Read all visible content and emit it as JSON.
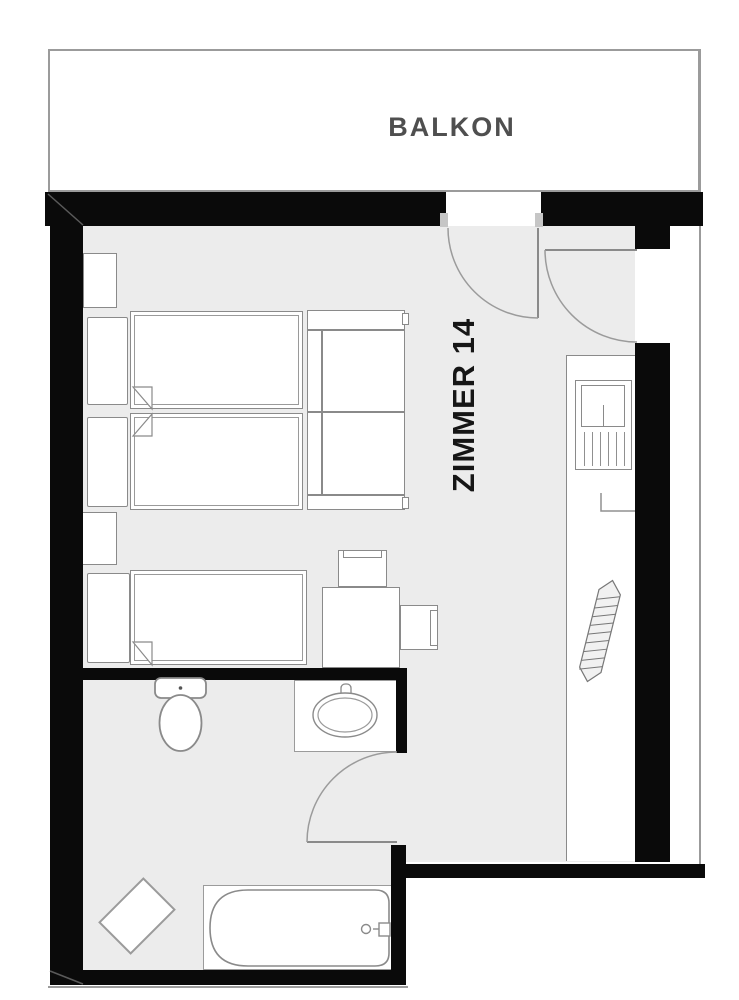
{
  "plan": {
    "title": "Hotel room floor plan",
    "labels": {
      "balcony": "BALKON",
      "room": "ZIMMER 14"
    },
    "colors": {
      "wall": "#0a0a0a",
      "floor": "#ececec",
      "furniture_outline": "#8a8a8a",
      "thin_line": "#9b9b9b",
      "balcony_label": "#4f4f4f",
      "room_label": "#161616",
      "background": "#ffffff"
    },
    "rooms": [
      {
        "name": "balcony",
        "label": "BALKON"
      },
      {
        "name": "bedroom",
        "label": "ZIMMER 14"
      },
      {
        "name": "bathroom",
        "label": ""
      }
    ],
    "furniture": [
      "nightstand",
      "single-bed",
      "single-bed",
      "nightstand",
      "single-bed",
      "sofa",
      "desk-chair",
      "desk",
      "side-chair",
      "wardrobe-counter",
      "tv-minibar-unit",
      "radiator",
      "toilet",
      "sink-vanity",
      "bathtub",
      "bath-mat"
    ],
    "doors": [
      "balcony-door",
      "entry-door",
      "bathroom-door"
    ]
  }
}
